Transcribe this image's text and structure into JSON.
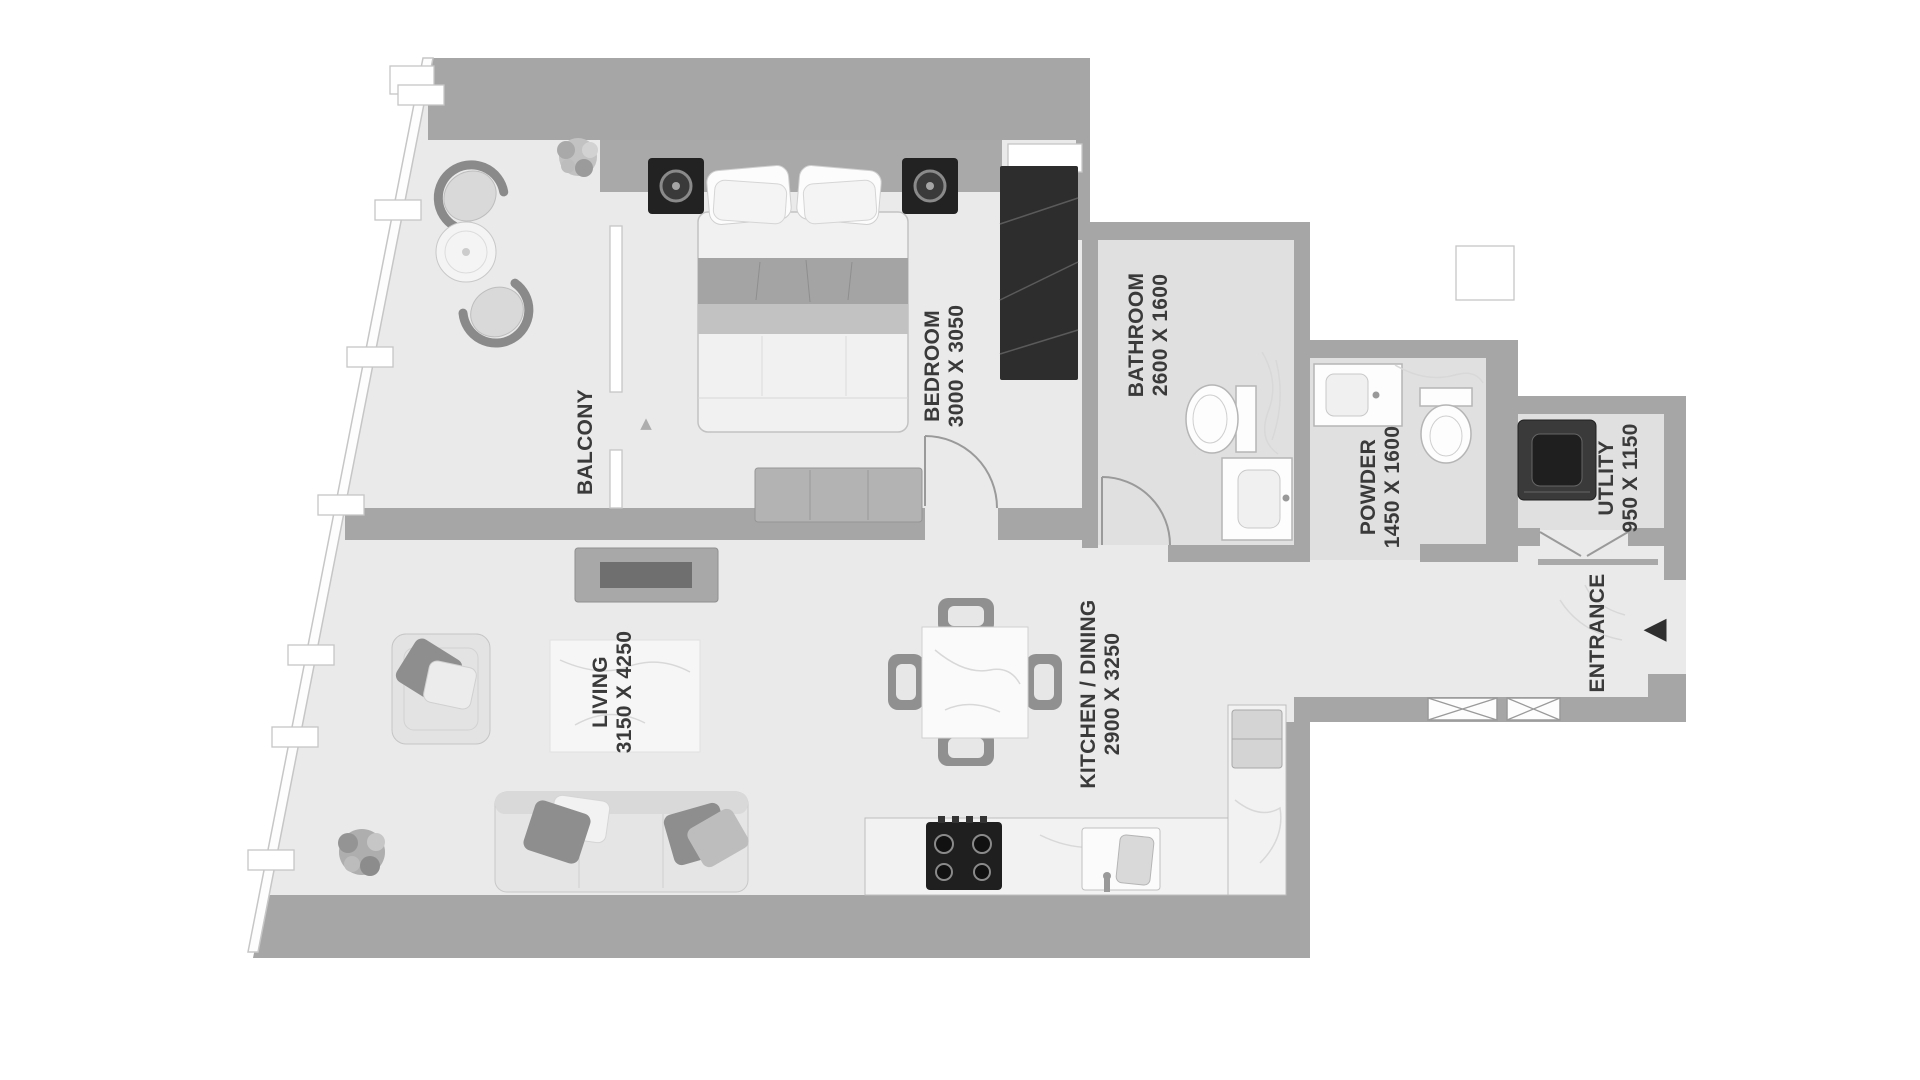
{
  "document": {
    "type": "apartment floor plan",
    "style": "grayscale top-view render"
  },
  "palette": {
    "background": "#ffffff",
    "wall": "#a6a6a6",
    "floor": "#eaeaea",
    "wet_room_floor": "#e0e0e0",
    "dark_furniture": "#2d2d2d",
    "label_text": "#3a3a3a",
    "outline": "#c6c6c6"
  },
  "rooms": {
    "balcony": {
      "name": "BALCONY"
    },
    "bedroom": {
      "name": "BEDROOM",
      "dims": "3000 X 3050"
    },
    "bathroom": {
      "name": "BATHROOM",
      "dims": "2600 X 1600"
    },
    "powder": {
      "name": "POWDER",
      "dims": "1450 X 1600"
    },
    "utility": {
      "name": "UTLITY",
      "dims": "950 X 1150"
    },
    "entrance": {
      "name": "ENTRANCE"
    },
    "living": {
      "name": "LIVING",
      "dims": "3150 X 4250"
    },
    "kitchen_dining": {
      "name": "KITCHEN / DINING",
      "dims": "2900 X 3250"
    }
  },
  "icons": {
    "entrance_arrow": "◀",
    "balcony_door_arrow": "▲"
  }
}
